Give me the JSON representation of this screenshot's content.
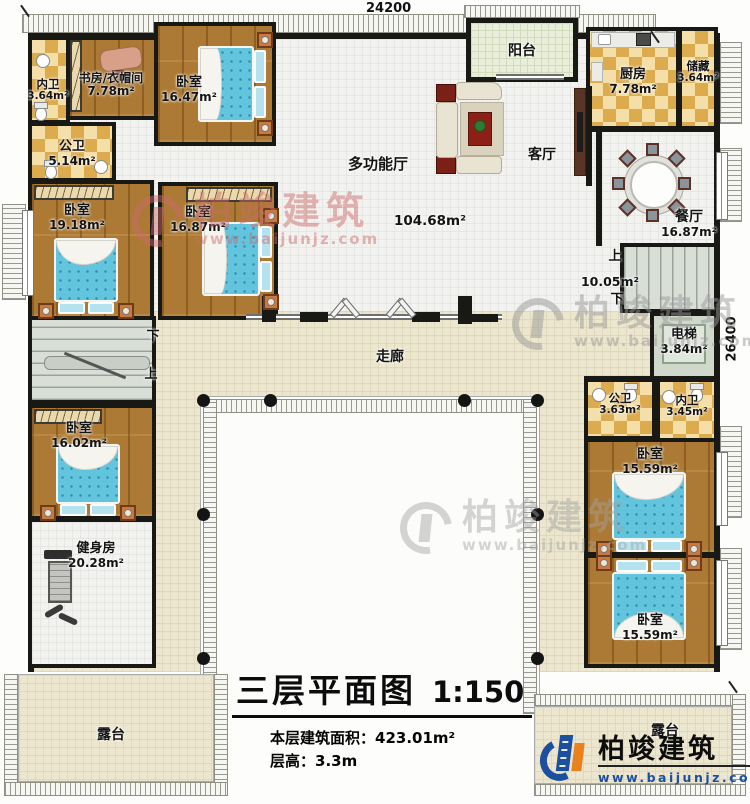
{
  "palette": {
    "wall": "#181815",
    "wood_floor": "#ac7a34",
    "tile_light": "#f3dfa7",
    "tile_dark": "#dcab4e",
    "hall_floor": "#f2f2f0",
    "corridor_floor": "#ebe6cd",
    "bed_blue": "#63c4de",
    "stair_gray": "#d9dfd7",
    "elevator_green": "#cfd8ca",
    "logo_blue": "#1c4f9e",
    "logo_orange": "#e8821e",
    "watermark_pink": "#cc6b6b",
    "watermark_gray": "#9a9a9a"
  },
  "dims": {
    "top": "24200",
    "right": "26400"
  },
  "title": {
    "main": "三层平面图",
    "scale": "1:150"
  },
  "stats": {
    "area_label": "本层建筑面积：",
    "area_value": "423.01m²",
    "height_label": "层高：",
    "height_value": "3.3m"
  },
  "brand": {
    "name": "柏竣建筑",
    "url": "www.baijunjz.com"
  },
  "rooms": {
    "neiwei_tl": {
      "name": "内卫",
      "area": "3.64m²"
    },
    "shufang": {
      "name": "书房/衣帽间",
      "area": "7.78m²"
    },
    "woshi_tl": {
      "name": "卧室",
      "area": "16.47m²"
    },
    "gongwei_tl": {
      "name": "公卫",
      "area": "5.14m²"
    },
    "woshi_l1": {
      "name": "卧室",
      "area": "19.18m²"
    },
    "woshi_l2": {
      "name": "卧室",
      "area": "16.87m²"
    },
    "yangtai": {
      "name": "阳台"
    },
    "chufang": {
      "name": "厨房",
      "area": "7.78m²"
    },
    "chucang": {
      "name": "储藏",
      "area": "3.64m²"
    },
    "keting": {
      "name": "客厅"
    },
    "duogongnengting": {
      "name": "多功能厅",
      "area": "104.68m²"
    },
    "canting": {
      "name": "餐厅",
      "area": "16.87m²"
    },
    "stair_right": {
      "up": "上",
      "down": "下",
      "area": "10.05m²"
    },
    "dianti": {
      "name": "电梯",
      "area": "3.84m²"
    },
    "stair_left": {
      "up": "上",
      "down": "下"
    },
    "zoulang": {
      "name": "走廊"
    },
    "gongwei_r": {
      "name": "公卫",
      "area": "3.63m²"
    },
    "neiwei_r": {
      "name": "内卫",
      "area": "3.45m²"
    },
    "woshi_r1": {
      "name": "卧室",
      "area": "15.59m²"
    },
    "woshi_r2": {
      "name": "卧室",
      "area": "15.59m²"
    },
    "woshi_l3": {
      "name": "卧室",
      "area": "16.02m²"
    },
    "jianshenfang": {
      "name": "健身房",
      "area": "20.28m²"
    },
    "lutai_left": {
      "name": "露台"
    },
    "lutai_right": {
      "name": "露台"
    }
  }
}
